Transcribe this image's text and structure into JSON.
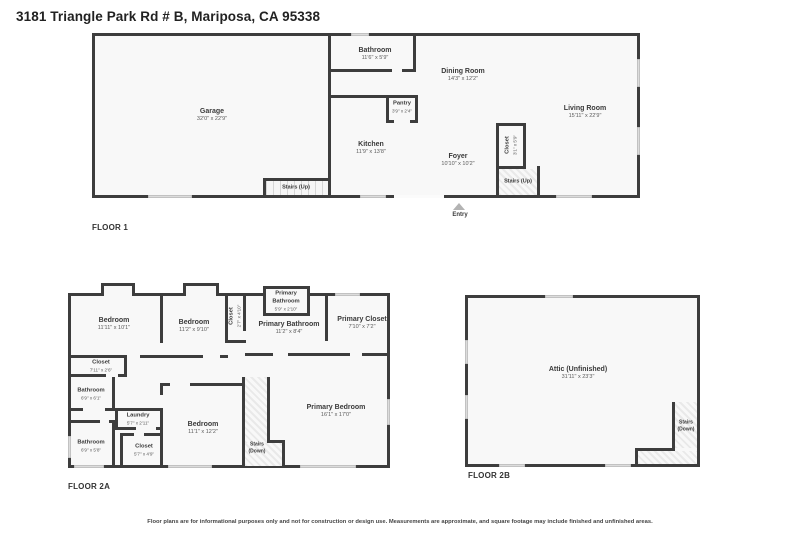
{
  "title": "3181 Triangle Park Rd # B, Mariposa, CA 95338",
  "footer": "Floor plans are for informational purposes only and not for construction or design use. Measurements are approximate, and square footage may include finished and unfinished areas.",
  "colors": {
    "wall": "#3d3d3d",
    "room_fill": "#f8f8f8",
    "window_marker": "#dcdcdc",
    "entry_marker": "#b3b3b3"
  },
  "floor1": {
    "label": "FLOOR 1",
    "entry_label": "Entry",
    "rooms": {
      "garage": {
        "name": "Garage",
        "dims": "32'0\" x 22'9\""
      },
      "bathroom": {
        "name": "Bathroom",
        "dims": "11'6\" x 5'9\""
      },
      "dining": {
        "name": "Dining Room",
        "dims": "14'3\" x 12'2\""
      },
      "pantry": {
        "name": "Pantry",
        "dims": "3'9\" x 2'4\""
      },
      "kitchen": {
        "name": "Kitchen",
        "dims": "11'9\" x 13'8\""
      },
      "living": {
        "name": "Living Room",
        "dims": "15'11\" x 22'9\""
      },
      "foyer": {
        "name": "Foyer",
        "dims": "10'10\" x 10'2\""
      },
      "closet": {
        "name": "Closet",
        "dims": "3'1\" x 5'9\""
      },
      "stairs_garage": {
        "name": "Stairs (Up)"
      },
      "stairs_foyer": {
        "name": "Stairs (Up)"
      }
    }
  },
  "floor2a": {
    "label": "FLOOR 2A",
    "rooms": {
      "bedroom1": {
        "name": "Bedroom",
        "dims": "11'11\" x 10'1\""
      },
      "bedroom2": {
        "name": "Bedroom",
        "dims": "11'2\" x 9'10\""
      },
      "closet_hall": {
        "name": "Closet",
        "dims": "2'7\" x 4'10\""
      },
      "primary_bath_small": {
        "name": "Primary Bathroom",
        "dims": "5'9\" x 2'10\""
      },
      "primary_bath": {
        "name": "Primary Bathroom",
        "dims": "11'2\" x 8'4\""
      },
      "primary_closet": {
        "name": "Primary Closet",
        "dims": "7'10\" x 7'2\""
      },
      "closet_top": {
        "name": "Closet",
        "dims": "7'11\" x 2'6\""
      },
      "bathroom1": {
        "name": "Bathroom",
        "dims": "6'9\" x 6'1\""
      },
      "laundry": {
        "name": "Laundry",
        "dims": "5'7\" x 2'11\""
      },
      "bathroom2": {
        "name": "Bathroom",
        "dims": "6'9\" x 5'8\""
      },
      "closet_bottom": {
        "name": "Closet",
        "dims": "5'7\" x 4'9\""
      },
      "bedroom3": {
        "name": "Bedroom",
        "dims": "11'1\" x 12'2\""
      },
      "stairs": {
        "name": "Stairs (Down)"
      },
      "primary_bedroom": {
        "name": "Primary Bedroom",
        "dims": "16'1\" x 17'0\""
      }
    }
  },
  "floor2b": {
    "label": "FLOOR 2B",
    "rooms": {
      "attic": {
        "name": "Attic (Unfinished)",
        "dims": "31'11\" x 23'3\""
      },
      "stairs": {
        "name": "Stairs (Down)"
      }
    }
  }
}
